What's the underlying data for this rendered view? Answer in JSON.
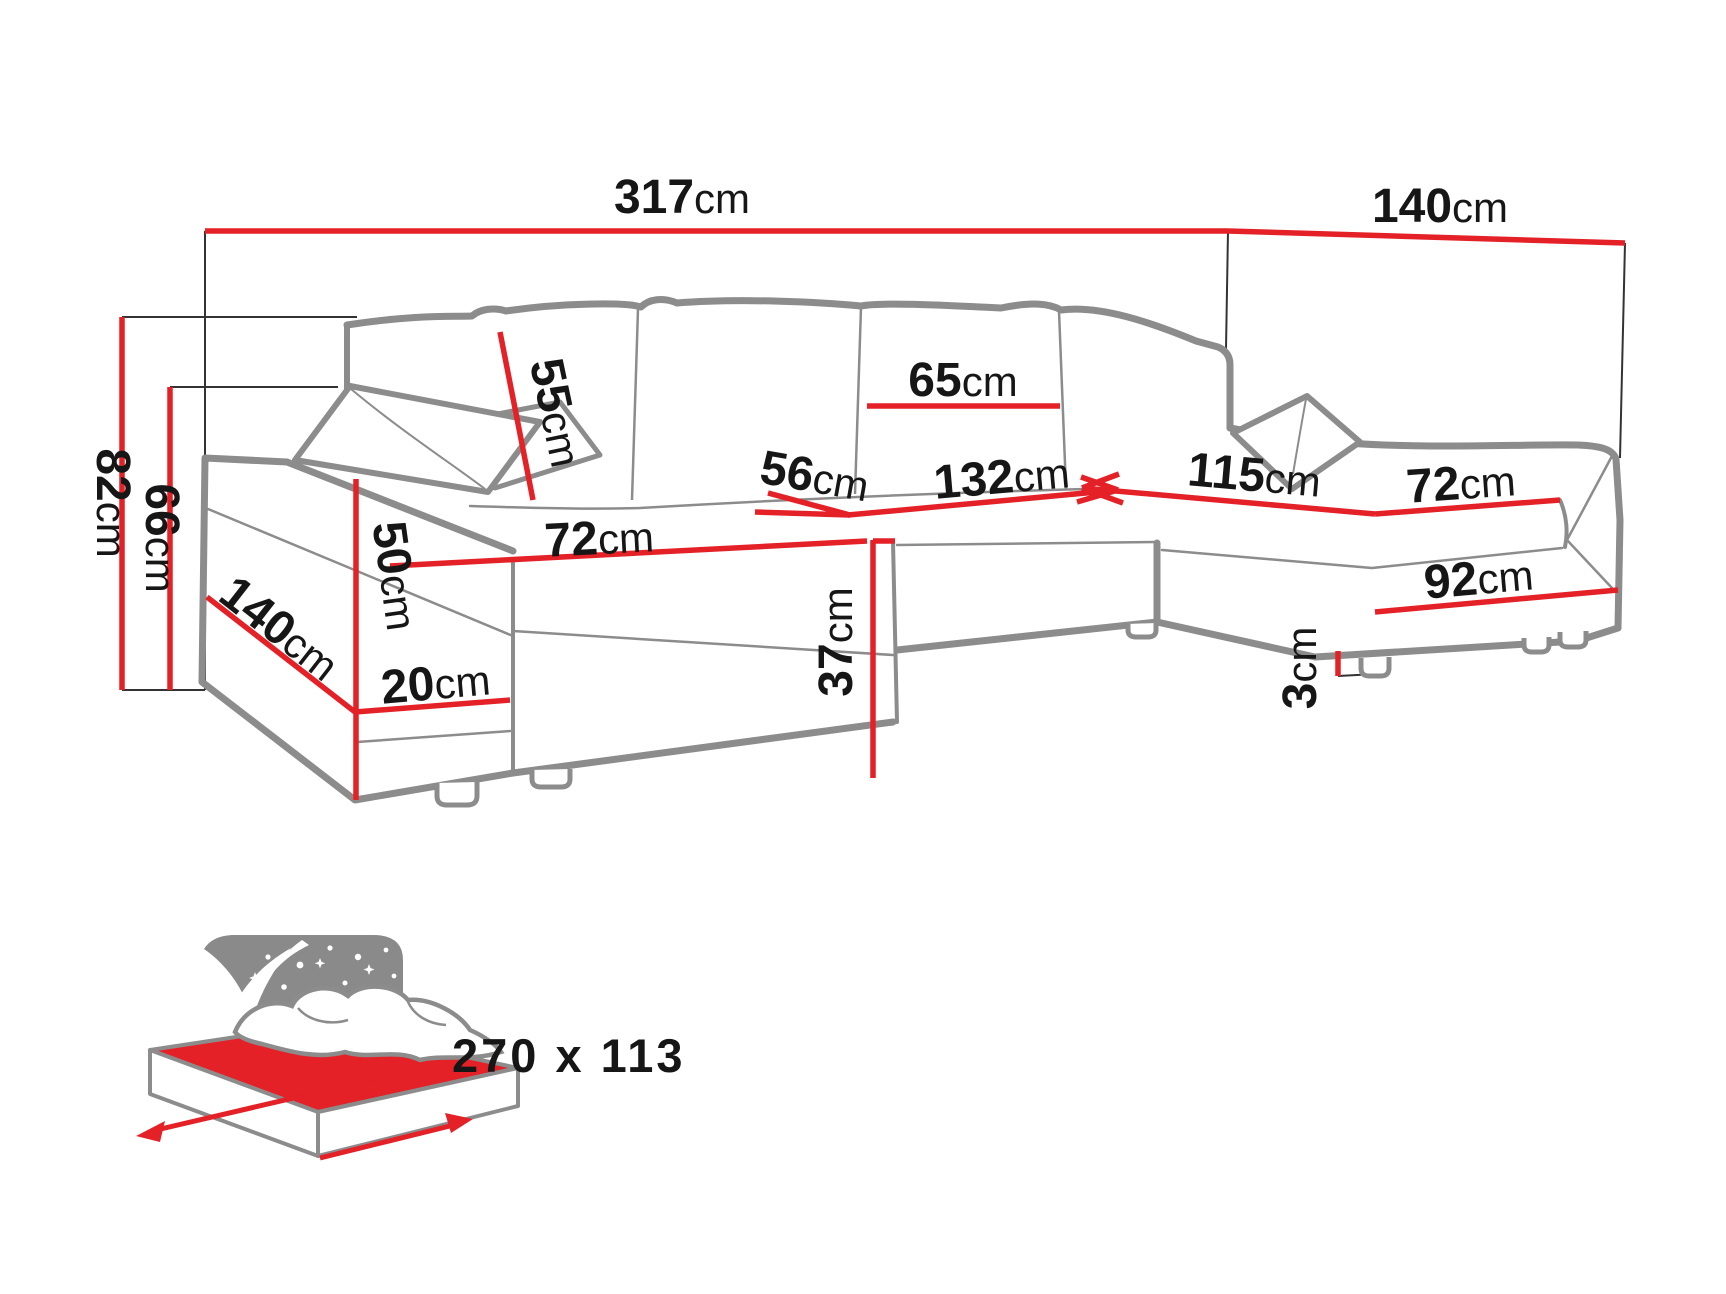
{
  "unit": "cm",
  "colors": {
    "dimension_red": "#e42127",
    "sofa_gray": "#8c8c8c",
    "icon_gray": "#8a8a8a",
    "text_black": "#161616"
  },
  "dims": {
    "total_width": {
      "value": "317",
      "unit": "cm"
    },
    "total_depth_right": {
      "value": "140",
      "unit": "cm"
    },
    "height_total": {
      "value": "82",
      "unit": "cm"
    },
    "height_back": {
      "value": "66",
      "unit": "cm"
    },
    "back_cushion": {
      "value": "55",
      "unit": "cm"
    },
    "center_cushion": {
      "value": "65",
      "unit": "cm"
    },
    "center_seat_depth": {
      "value": "56",
      "unit": "cm"
    },
    "center_seat_width": {
      "value": "132",
      "unit": "cm"
    },
    "right_seat_length": {
      "value": "115",
      "unit": "cm"
    },
    "right_seat_width": {
      "value": "72",
      "unit": "cm"
    },
    "right_base_length": {
      "value": "92",
      "unit": "cm"
    },
    "leg_height": {
      "value": "3",
      "unit": "cm"
    },
    "left_seat_width": {
      "value": "72",
      "unit": "cm"
    },
    "left_base_strip": {
      "value": "20",
      "unit": "cm"
    },
    "seat_height": {
      "value": "37",
      "unit": "cm"
    },
    "armrest_height": {
      "value": "50",
      "unit": "cm"
    },
    "left_chaise_depth": {
      "value": "140",
      "unit": "cm"
    }
  },
  "bed_icon": {
    "label": "270 x 113"
  }
}
